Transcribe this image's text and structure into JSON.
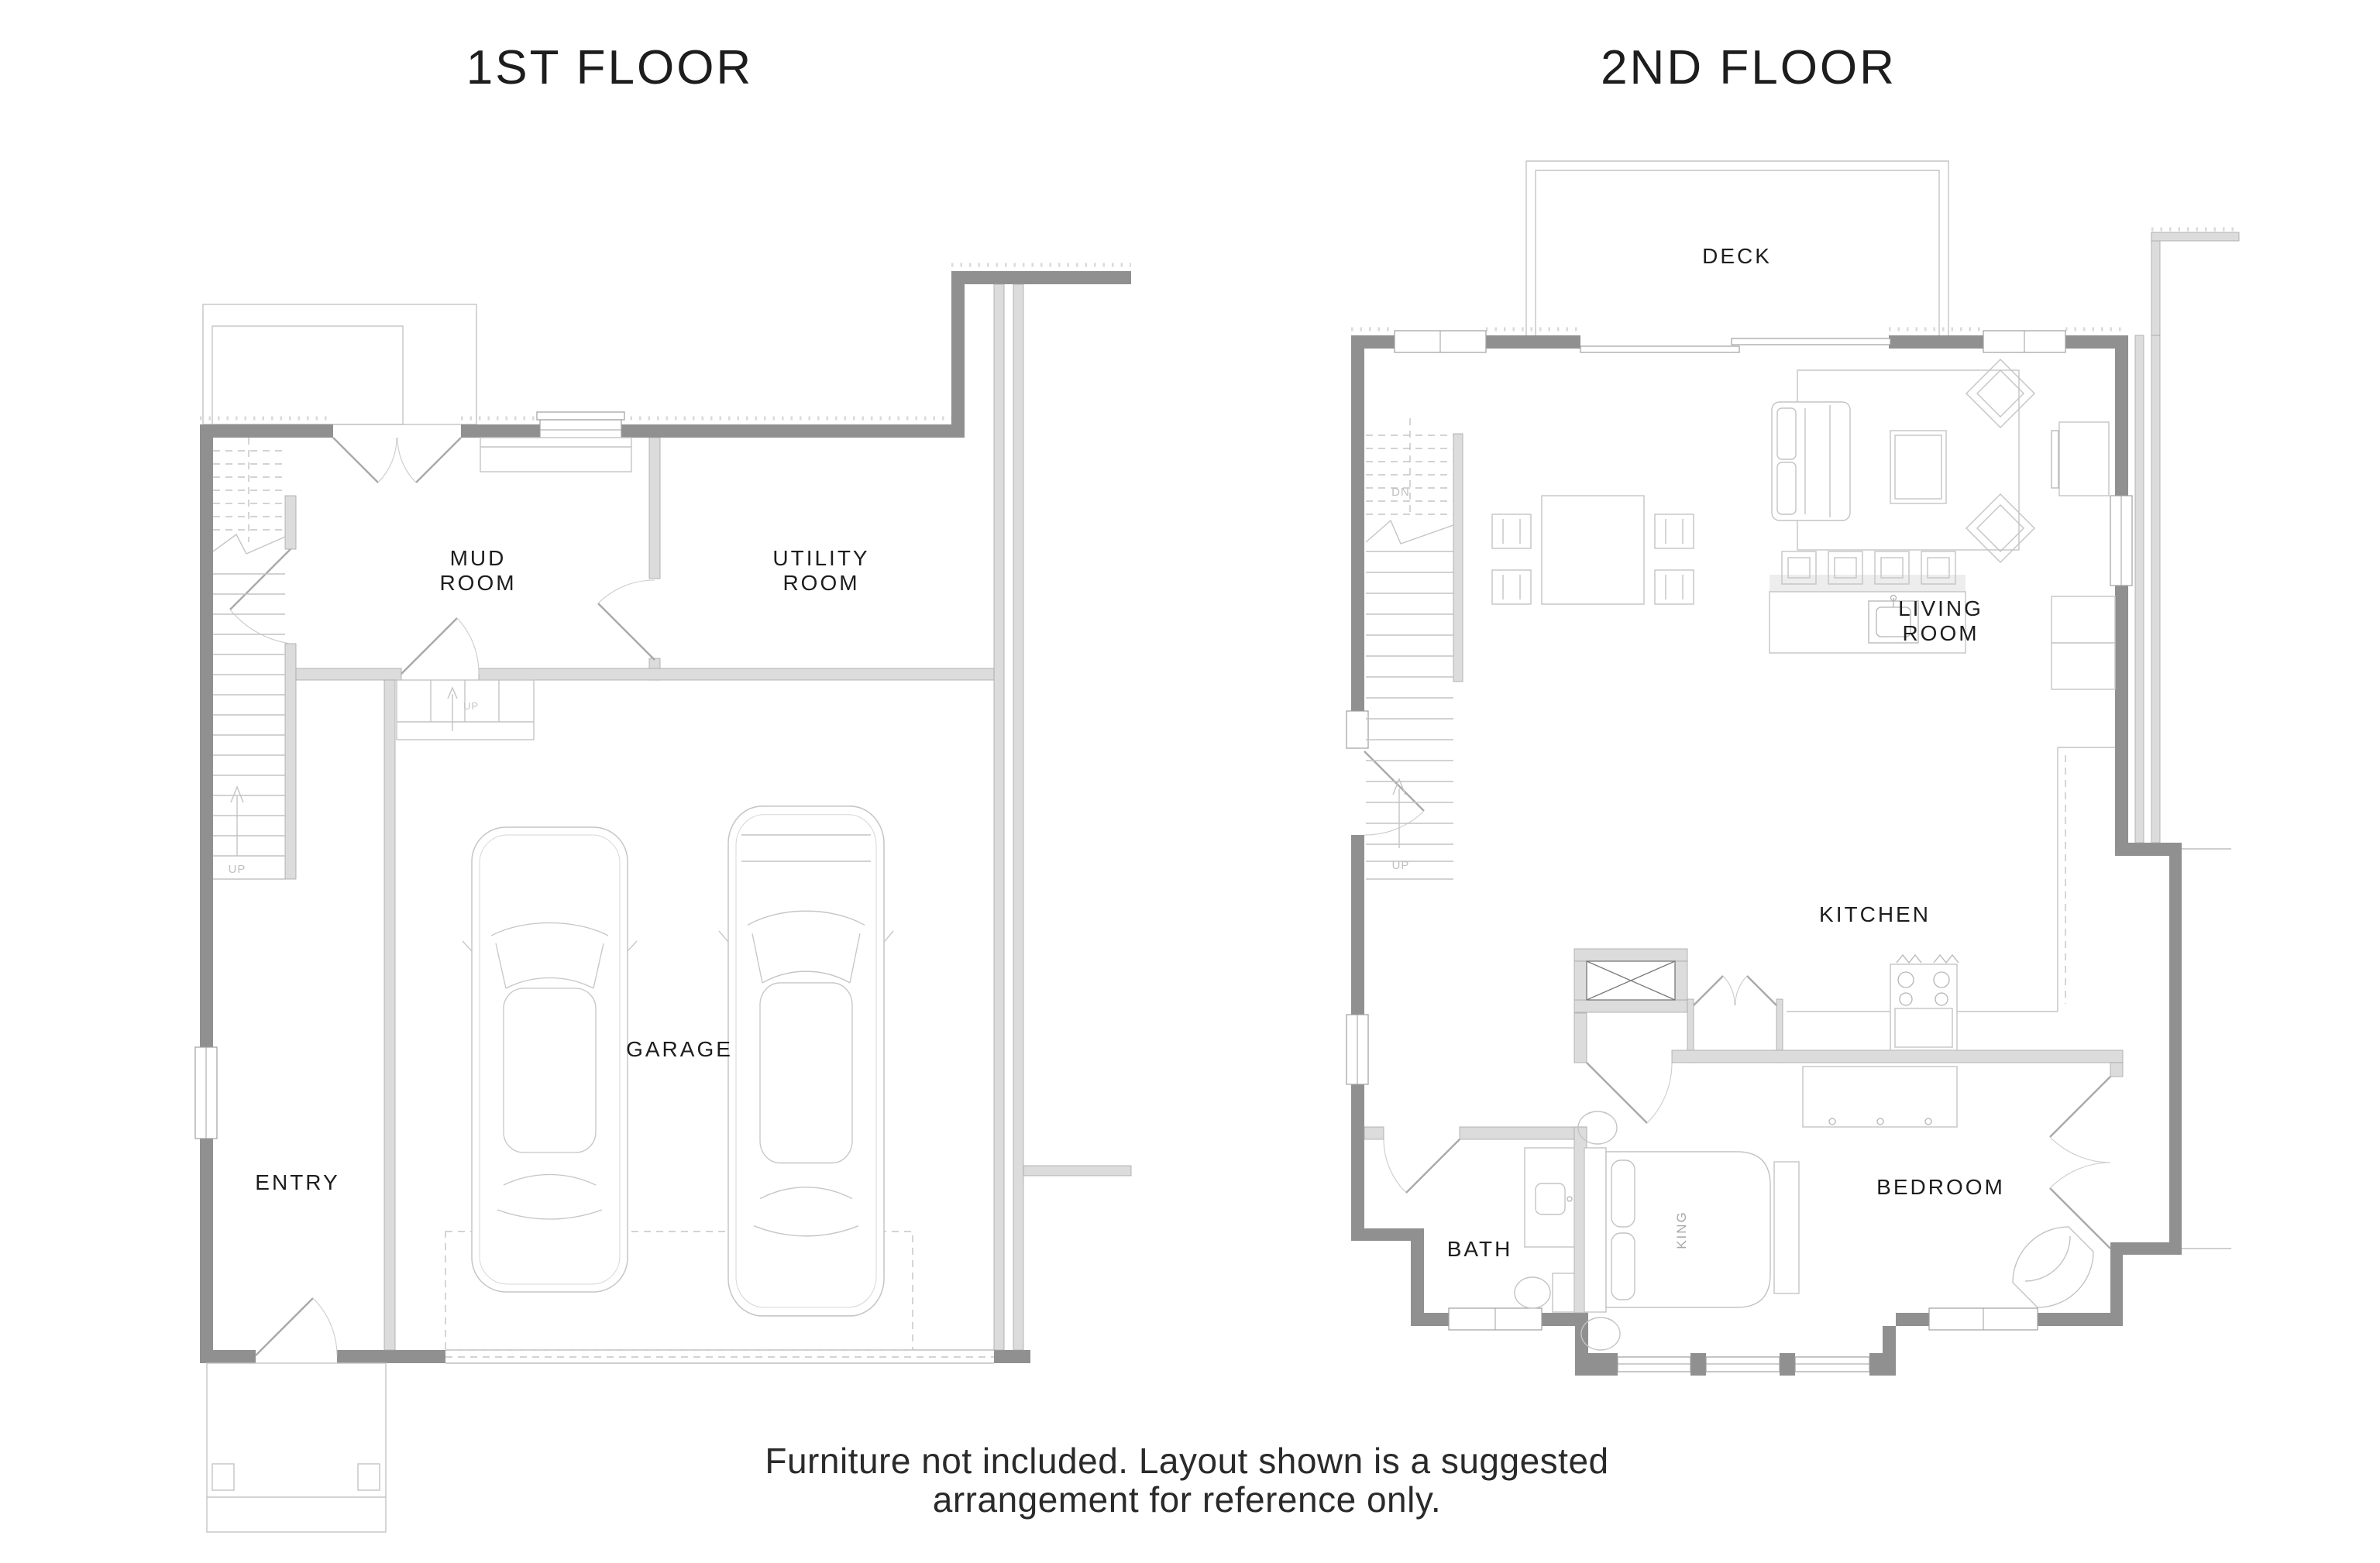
{
  "titles": {
    "floor1": "1ST FLOOR",
    "floor2": "2ND FLOOR"
  },
  "floor1": {
    "labels": {
      "mud_room_line1": "MUD",
      "mud_room_line2": "ROOM",
      "utility_room_line1": "UTILITY",
      "utility_room_line2": "ROOM",
      "garage": "GARAGE",
      "entry": "ENTRY",
      "stairs_up": "UP",
      "steps_up": "UP"
    }
  },
  "floor2": {
    "labels": {
      "deck": "DECK",
      "living_room_line1": "LIVING",
      "living_room_line2": "ROOM",
      "kitchen": "KITCHEN",
      "bedroom": "BEDROOM",
      "bath": "BATH",
      "bed_king": "KING",
      "stairs_down": "DN",
      "stairs_up": "UP"
    }
  },
  "footnote": {
    "line1": "Furniture not included. Layout shown is a suggested",
    "line2": "arrangement for reference only."
  },
  "colors": {
    "background": "#ffffff",
    "wall_dark": "#909090",
    "wall_light": "#dcdcdc",
    "wall_outline": "#a6a6a6",
    "furniture_line": "#c4c4c4",
    "text_primary": "#1d1d1d",
    "text_muted": "#c0c0c0"
  }
}
